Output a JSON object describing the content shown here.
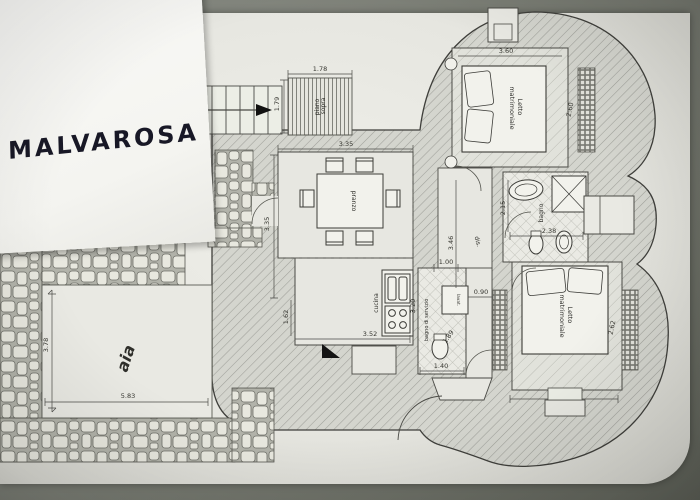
{
  "note": {
    "title": "MALVAROSA"
  },
  "plan": {
    "labels": {
      "loft_line1": "piano",
      "loft_line2": "sopra",
      "dining_table": "pranzo",
      "kitchen": "cucina",
      "service_bath": "bagno di servizio",
      "laundry": "lavat.",
      "hall": "dis.",
      "bath": "bagno",
      "bedroom_top_line1": "Letto",
      "bedroom_top_line2": "matrimoniale",
      "bedroom_bottom_line1": "Letto",
      "bedroom_bottom_line2": "matrimoniale",
      "courtyard": "aia"
    },
    "dimensions": {
      "loft_w": "1.78",
      "loft_h": "1.79",
      "dining_w": "3.35",
      "dining_h": "3.35",
      "kitchen_h": "1.62",
      "kitchen_w": "3.52",
      "hall_h": "3.46",
      "hall_w": "1.00",
      "hall_gap": "0.90",
      "bath_w": "2.38",
      "bath_h": "2.15",
      "bedroom_top_w": "3.60",
      "bedroom_top_r": "2.60",
      "bedroom_bottom_w": "3.50",
      "bedroom_bottom_r": "2.62",
      "service_bath_h": "3.20",
      "service_bath_w": "1.40",
      "service_bath_d": "1.89",
      "courtyard_h": "3.78",
      "courtyard_w": "5.83"
    }
  }
}
